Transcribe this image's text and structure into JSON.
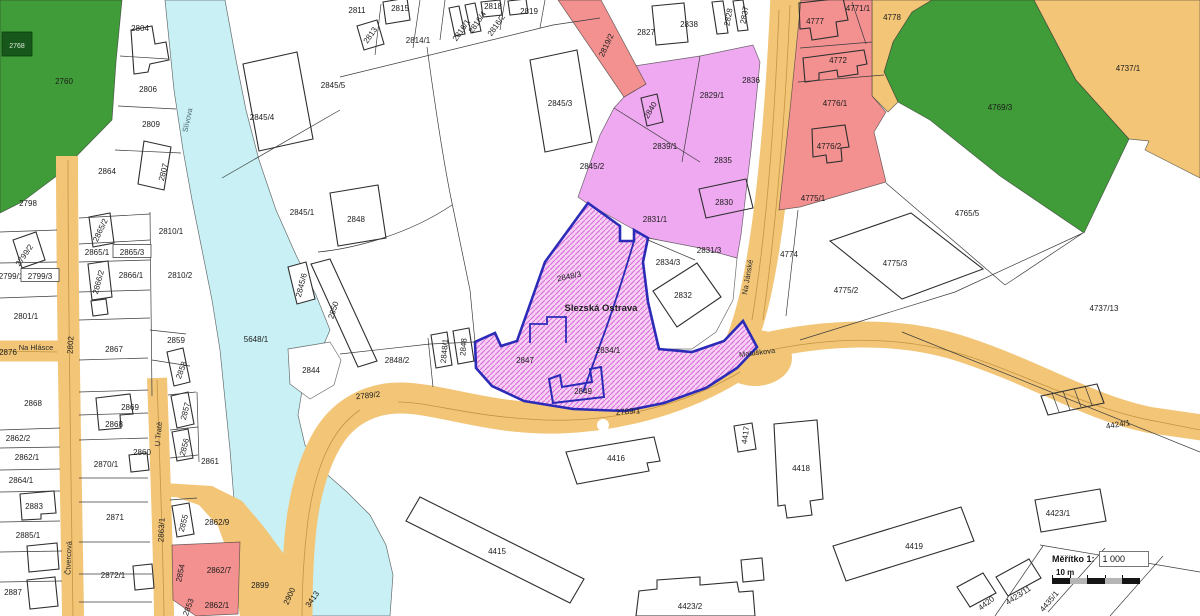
{
  "map": {
    "area_name": "Slezská Ostrava",
    "colors": {
      "forest": "#3f9c38",
      "water": "#c9f1f5",
      "road": "#f2c577",
      "residential_zone": "#efa9f0",
      "commercial_zone": "#f2918f",
      "selection_fill": "#f8d2f4",
      "selection_hatch": "#d973da",
      "selection_border": "#2b2bb8",
      "area_label": "#c23a52"
    },
    "labels": [
      {
        "t": "2760",
        "x": 64,
        "y": 81
      },
      {
        "t": "2768",
        "x": 17,
        "y": 45,
        "k": "badge"
      },
      {
        "t": "2804",
        "x": 140,
        "y": 28
      },
      {
        "t": "2806",
        "x": 148,
        "y": 89
      },
      {
        "t": "2809",
        "x": 151,
        "y": 124
      },
      {
        "t": "2807",
        "x": 163,
        "y": 172,
        "r": -75
      },
      {
        "t": "2864",
        "x": 107,
        "y": 171
      },
      {
        "t": "2798",
        "x": 28,
        "y": 203
      },
      {
        "t": "2865/2",
        "x": 100,
        "y": 230,
        "r": -65
      },
      {
        "t": "2865/1",
        "x": 97,
        "y": 252
      },
      {
        "t": "2865/3",
        "x": 132,
        "y": 252,
        "k": "box"
      },
      {
        "t": "2810/1",
        "x": 171,
        "y": 231
      },
      {
        "t": "2799/2",
        "x": 24,
        "y": 255,
        "r": -55
      },
      {
        "t": "2799/1",
        "x": 11,
        "y": 276
      },
      {
        "t": "2799/3",
        "x": 40,
        "y": 276,
        "k": "box"
      },
      {
        "t": "2866/1",
        "x": 131,
        "y": 275
      },
      {
        "t": "2866/2",
        "x": 98,
        "y": 282,
        "r": -75
      },
      {
        "t": "2810/2",
        "x": 180,
        "y": 275
      },
      {
        "t": "2801/1",
        "x": 26,
        "y": 316
      },
      {
        "t": "2859",
        "x": 176,
        "y": 340
      },
      {
        "t": "2858",
        "x": 181,
        "y": 370,
        "r": -70
      },
      {
        "t": "2876",
        "x": 8,
        "y": 352
      },
      {
        "t": "Na Hlásce",
        "x": 36,
        "y": 347,
        "k": "s"
      },
      {
        "t": "2802",
        "x": 70,
        "y": 345,
        "r": -87
      },
      {
        "t": "2867",
        "x": 114,
        "y": 349
      },
      {
        "t": "Slívova",
        "x": 187,
        "y": 120,
        "r": -78,
        "k": "w"
      },
      {
        "t": "5648/1",
        "x": 256,
        "y": 339
      },
      {
        "t": "2844",
        "x": 311,
        "y": 370
      },
      {
        "t": "2845/6",
        "x": 301,
        "y": 285,
        "r": -75
      },
      {
        "t": "2850",
        "x": 333,
        "y": 310,
        "r": -72
      },
      {
        "t": "2848/2",
        "x": 397,
        "y": 360
      },
      {
        "t": "2848/1",
        "x": 444,
        "y": 351,
        "r": -85
      },
      {
        "t": "2848",
        "x": 463,
        "y": 347,
        "r": -85
      },
      {
        "t": "2789/2",
        "x": 368,
        "y": 395,
        "r": -6
      },
      {
        "t": "2789/1",
        "x": 628,
        "y": 411,
        "r": -4
      },
      {
        "t": "2845/4",
        "x": 262,
        "y": 117
      },
      {
        "t": "2845/5",
        "x": 333,
        "y": 85
      },
      {
        "t": "2845/3",
        "x": 560,
        "y": 103
      },
      {
        "t": "2845/2",
        "x": 592,
        "y": 166
      },
      {
        "t": "2845/1",
        "x": 302,
        "y": 212
      },
      {
        "t": "2848",
        "x": 356,
        "y": 219
      },
      {
        "t": "2811",
        "x": 357,
        "y": 10
      },
      {
        "t": "2815",
        "x": 400,
        "y": 8
      },
      {
        "t": "2813",
        "x": 370,
        "y": 35,
        "r": -55
      },
      {
        "t": "2814/1",
        "x": 418,
        "y": 40
      },
      {
        "t": "2816/1",
        "x": 461,
        "y": 30,
        "r": -55
      },
      {
        "t": "2816/4",
        "x": 477,
        "y": 22,
        "r": -55
      },
      {
        "t": "2816/2",
        "x": 496,
        "y": 25,
        "r": -55
      },
      {
        "t": "2818",
        "x": 493,
        "y": 6
      },
      {
        "t": "2819",
        "x": 529,
        "y": 11
      },
      {
        "t": "2819/2",
        "x": 606,
        "y": 45,
        "r": -65
      },
      {
        "t": "2827",
        "x": 646,
        "y": 32
      },
      {
        "t": "2838",
        "x": 689,
        "y": 24
      },
      {
        "t": "2828",
        "x": 728,
        "y": 17,
        "r": -80
      },
      {
        "t": "2837",
        "x": 744,
        "y": 15,
        "r": -80
      },
      {
        "t": "2840",
        "x": 650,
        "y": 110,
        "r": -60
      },
      {
        "t": "2836",
        "x": 751,
        "y": 80
      },
      {
        "t": "2829/1",
        "x": 712,
        "y": 95
      },
      {
        "t": "2839/1",
        "x": 665,
        "y": 146
      },
      {
        "t": "2835",
        "x": 723,
        "y": 160
      },
      {
        "t": "2830",
        "x": 724,
        "y": 202
      },
      {
        "t": "2831/1",
        "x": 655,
        "y": 219
      },
      {
        "t": "2831/3",
        "x": 709,
        "y": 250
      },
      {
        "t": "2834/3",
        "x": 668,
        "y": 262
      },
      {
        "t": "2832",
        "x": 683,
        "y": 295
      },
      {
        "t": "2848/3",
        "x": 569,
        "y": 276,
        "r": -12
      },
      {
        "t": "Slezská Ostrava",
        "x": 601,
        "y": 308,
        "k": "a"
      },
      {
        "t": "2834/1",
        "x": 608,
        "y": 350
      },
      {
        "t": "2847",
        "x": 525,
        "y": 360
      },
      {
        "t": "2849",
        "x": 583,
        "y": 391
      },
      {
        "t": "4777",
        "x": 815,
        "y": 21
      },
      {
        "t": "4771/1",
        "x": 858,
        "y": 8
      },
      {
        "t": "4778",
        "x": 892,
        "y": 17
      },
      {
        "t": "4772",
        "x": 838,
        "y": 60
      },
      {
        "t": "4776/1",
        "x": 835,
        "y": 103
      },
      {
        "t": "4776/2",
        "x": 829,
        "y": 146
      },
      {
        "t": "4775/1",
        "x": 813,
        "y": 198
      },
      {
        "t": "4769/3",
        "x": 1000,
        "y": 107
      },
      {
        "t": "4737/1",
        "x": 1128,
        "y": 68
      },
      {
        "t": "4765/5",
        "x": 967,
        "y": 213
      },
      {
        "t": "4774",
        "x": 789,
        "y": 254
      },
      {
        "t": "Na Jánské",
        "x": 747,
        "y": 277,
        "r": -80,
        "k": "s"
      },
      {
        "t": "4775/3",
        "x": 895,
        "y": 263
      },
      {
        "t": "4775/2",
        "x": 846,
        "y": 290
      },
      {
        "t": "4737/13",
        "x": 1104,
        "y": 308
      },
      {
        "t": "Matuškova",
        "x": 757,
        "y": 352,
        "r": -7,
        "k": "s"
      },
      {
        "t": "4424/1",
        "x": 1118,
        "y": 424,
        "r": -9
      },
      {
        "t": "4416",
        "x": 616,
        "y": 458
      },
      {
        "t": "4415",
        "x": 497,
        "y": 551
      },
      {
        "t": "4417",
        "x": 745,
        "y": 435,
        "r": -82
      },
      {
        "t": "4418",
        "x": 801,
        "y": 468
      },
      {
        "t": "4419",
        "x": 914,
        "y": 546
      },
      {
        "t": "4423/2",
        "x": 690,
        "y": 606
      },
      {
        "t": "4423/1",
        "x": 1058,
        "y": 513
      },
      {
        "t": "4420",
        "x": 986,
        "y": 603,
        "r": -38
      },
      {
        "t": "4423/11",
        "x": 1018,
        "y": 595,
        "r": -33
      },
      {
        "t": "4435/1",
        "x": 1049,
        "y": 601,
        "r": -50
      },
      {
        "t": "2869",
        "x": 130,
        "y": 407
      },
      {
        "t": "2868",
        "x": 114,
        "y": 424
      },
      {
        "t": "2868",
        "x": 33,
        "y": 403
      },
      {
        "t": "2870/1",
        "x": 106,
        "y": 464
      },
      {
        "t": "2871",
        "x": 115,
        "y": 517
      },
      {
        "t": "2872/1",
        "x": 113,
        "y": 575
      },
      {
        "t": "2857",
        "x": 185,
        "y": 411,
        "r": -75
      },
      {
        "t": "2856",
        "x": 184,
        "y": 447,
        "r": -75
      },
      {
        "t": "2861",
        "x": 210,
        "y": 461
      },
      {
        "t": "2860",
        "x": 142,
        "y": 452
      },
      {
        "t": "U Tratě",
        "x": 158,
        "y": 434,
        "r": -85,
        "k": "s"
      },
      {
        "t": "2863/1",
        "x": 161,
        "y": 530,
        "r": -87
      },
      {
        "t": "Čtvercová",
        "x": 68,
        "y": 558,
        "r": -88,
        "k": "s"
      },
      {
        "t": "2862/2",
        "x": 18,
        "y": 438
      },
      {
        "t": "2862/1",
        "x": 27,
        "y": 457
      },
      {
        "t": "2864/1",
        "x": 21,
        "y": 480
      },
      {
        "t": "2883",
        "x": 34,
        "y": 506
      },
      {
        "t": "2885/1",
        "x": 28,
        "y": 535
      },
      {
        "t": "2887",
        "x": 13,
        "y": 592
      },
      {
        "t": "2855",
        "x": 183,
        "y": 523,
        "r": -75
      },
      {
        "t": "2862/9",
        "x": 217,
        "y": 522
      },
      {
        "t": "2854",
        "x": 180,
        "y": 573,
        "r": -78
      },
      {
        "t": "2862/7",
        "x": 219,
        "y": 570
      },
      {
        "t": "2853",
        "x": 188,
        "y": 607,
        "r": -70
      },
      {
        "t": "2862/1",
        "x": 217,
        "y": 605
      },
      {
        "t": "2899",
        "x": 260,
        "y": 585
      },
      {
        "t": "2900",
        "x": 289,
        "y": 596,
        "r": -65
      },
      {
        "t": "3413",
        "x": 312,
        "y": 599,
        "r": -55
      }
    ]
  },
  "scale_widget": {
    "label": "Měřítko 1:",
    "value": "1 000",
    "bar_label": "10 m"
  }
}
